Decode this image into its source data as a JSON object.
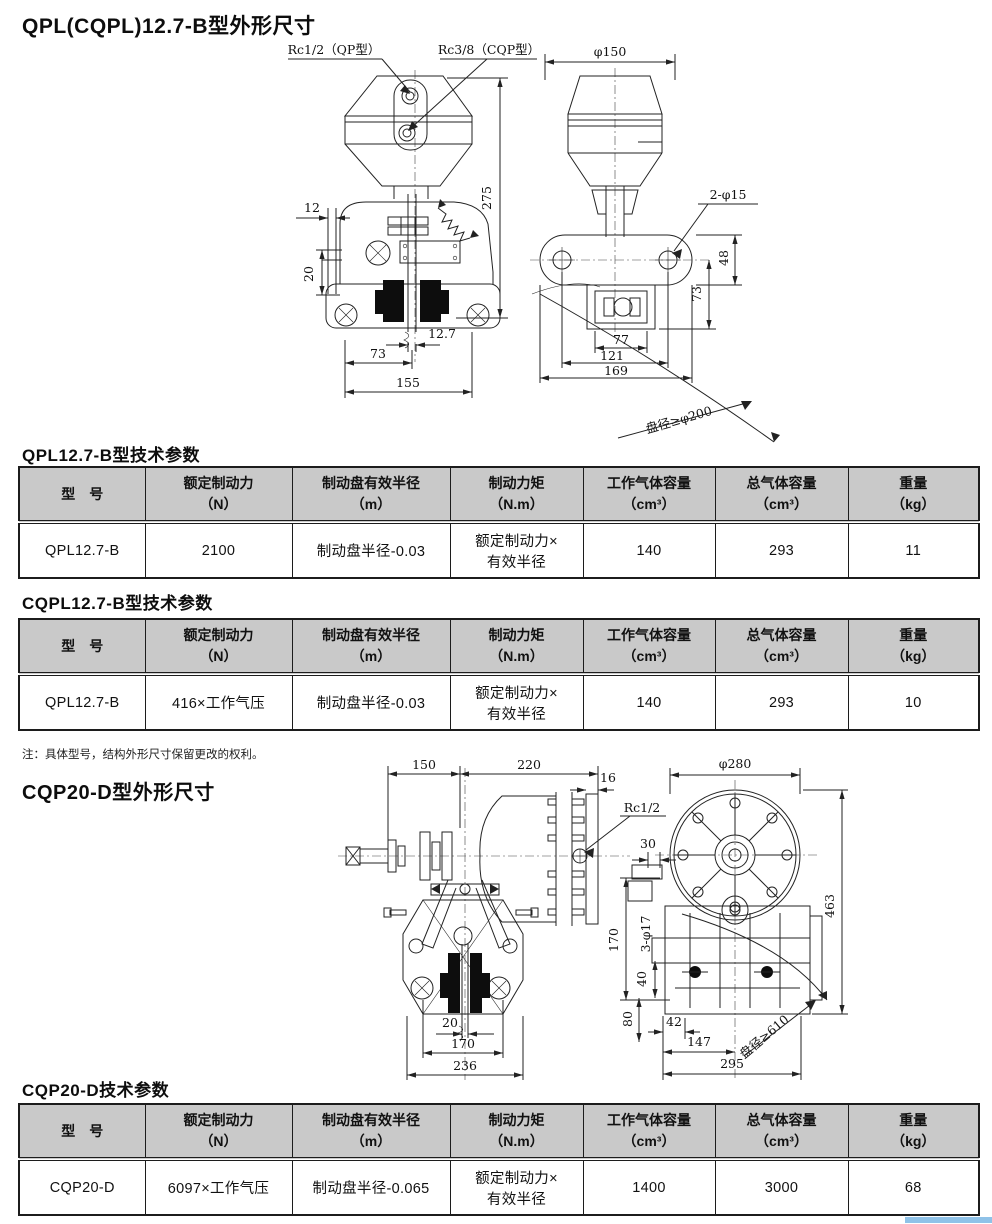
{
  "sections": {
    "s1": "QPL(CQPL)12.7-B型外形尺寸",
    "s2": "QPL12.7-B型技术参数",
    "s3": "CQPL12.7-B型技术参数",
    "s4": "CQP20-D型外形尺寸",
    "s5": "CQP20-D技术参数"
  },
  "note": {
    "text": "注：具体型号，结构外形尺寸保留更改的权利。"
  },
  "tables": {
    "headers": [
      "型　号",
      "额定制动力\n（N）",
      "制动盘有效半径\n（m）",
      "制动力矩\n（N.m）",
      "工作气体容量\n（cm³）",
      "总气体容量\n（cm³）",
      "重量\n（kg）"
    ],
    "t1": {
      "row": [
        "QPL12.7-B",
        "2100",
        "制动盘半径-0.03",
        "额定制动力×\n有效半径",
        "140",
        "293",
        "11"
      ]
    },
    "t2": {
      "row": [
        "QPL12.7-B",
        "416×工作气压",
        "制动盘半径-0.03",
        "额定制动力×\n有效半径",
        "140",
        "293",
        "10"
      ]
    },
    "t3": {
      "row": [
        "CQP20-D",
        "6097×工作气压",
        "制动盘半径-0.065",
        "额定制动力×\n有效半径",
        "1400",
        "3000",
        "68"
      ]
    }
  },
  "dwg1": {
    "front": {
      "rc12": "Rc1/2（QP型）",
      "rc38": "Rc3/8（CQP型）",
      "d12": "12",
      "d20": "20",
      "d127": "12.7",
      "d73": "73",
      "d155": "155",
      "d275": "275"
    },
    "side": {
      "phi150": "φ150",
      "phi15": "2-φ15",
      "d48": "48",
      "d73": "73",
      "d77": "77",
      "d121": "121",
      "d169": "169",
      "disc": "盘径≥φ200"
    }
  },
  "dwg2": {
    "side": {
      "d150": "150",
      "d220": "220",
      "d16": "16",
      "rc12": "Rc1/2",
      "d20": "20",
      "d170": "170",
      "d236": "236"
    },
    "front": {
      "phi280": "φ280",
      "d30": "30",
      "phi17": "3-φ17",
      "d170": "170",
      "d40": "40",
      "d80": "80",
      "d463": "463",
      "d42": "42",
      "d147": "147",
      "d295": "295",
      "disc": "盘径≥610"
    }
  },
  "colors": {
    "table_header_bg": "#c9c9c9",
    "accent_bar": "#8fc2e8",
    "line": "#222222"
  }
}
